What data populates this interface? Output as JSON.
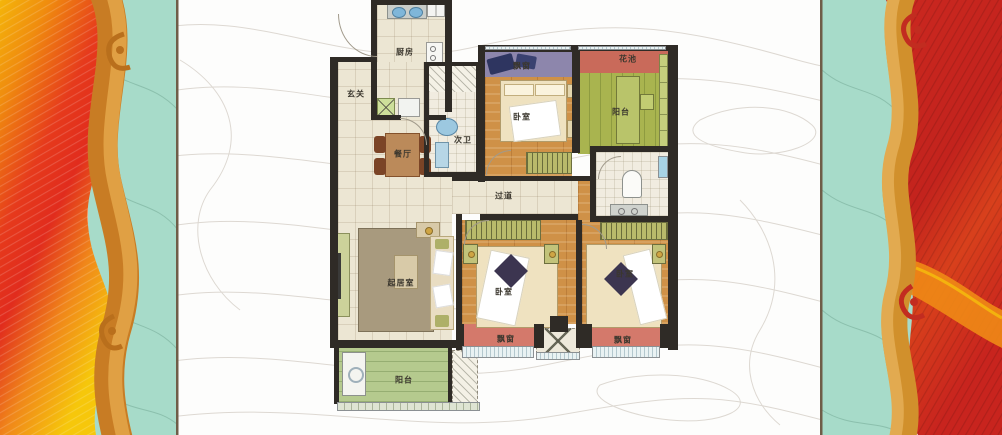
{
  "floorplan": {
    "labels": {
      "kitchen": "厨房",
      "entry": "玄关",
      "dining": "餐厅",
      "bath2": "次卫",
      "corridor": "过道",
      "living": "起居室",
      "bedroom_top": "卧室",
      "bedroom_mid": "卧室",
      "bedroom_right": "卧室",
      "bay_top": "飘窗",
      "bay_mid": "飘窗",
      "bay_right": "飘窗",
      "balcony_top": "阳台",
      "balcony_bottom": "阳台",
      "flower_bed": "花池"
    },
    "colors": {
      "wall": "#2f2b26",
      "tile": "#ece6d3",
      "wood": "#cf9147",
      "bay_red": "#d4796b",
      "bay_purple": "#8d86ac",
      "flower_red": "#c96a5a",
      "balcony_green_top": "#a9b44f",
      "balcony_green_bottom": "#b5ca8e",
      "wardrobe_olive": "#b9ba6b",
      "bath_floor": "#f1ece0",
      "rug": "#a89a7e",
      "bed_cream": "#efe2c0",
      "teal": "#a7dbc9",
      "flame_yellow": "#f6c70b",
      "flame_orange": "#f0861a",
      "flame_red": "#e12c1d",
      "scroll_orange": "#cd8430",
      "deep_red": "#cb2820",
      "separator": "#6f5d48",
      "contour": "#dcd7d0",
      "label_ink": "#3b372e"
    }
  }
}
